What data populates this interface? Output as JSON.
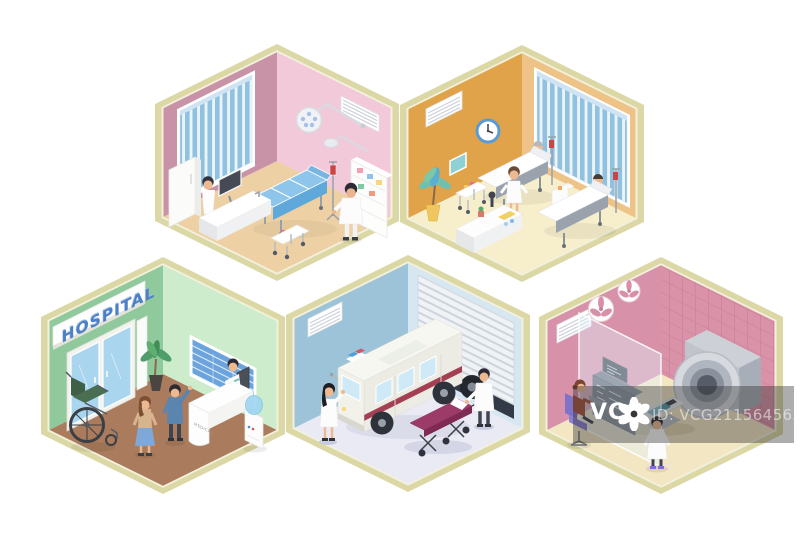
{
  "reception": {
    "sign": "HOSPITAL",
    "desk_label": "MEDICAL"
  },
  "watermark": {
    "brand": "VCG",
    "id_text": "ID: VCG211564563893",
    "overlay_color": "#adadad",
    "logo_icon": "flower-asterisk"
  },
  "palette": {
    "background": "#ffffff",
    "hex_border": "#dcd8a6",
    "hex_border_inner": "#f3f1dd",
    "operating_room": {
      "left_wall": "#c893a6",
      "right_wall": "#f2c9d9",
      "floor": "#edd1a5",
      "exam_bed": "#8ec5ea"
    },
    "ward": {
      "left_wall": "#e1a349",
      "right_wall": "#eec387",
      "floor": "#f7eecb",
      "clock_ring": "#5b9bd5",
      "blinds": "#90c1de"
    },
    "reception_room": {
      "left_wall": "#90c99b",
      "right_wall": "#cdeccb",
      "floor": "#aa7b5c",
      "sign_text": "#4d7fc4",
      "notice_board": "#6aa3dd",
      "door_glass": "#a9d5ef"
    },
    "garage": {
      "left_wall": "#9dc3d8",
      "right_wall": "#d6e7f2",
      "floor": "#eaeaf5",
      "ambulance_stripe": "#a34053",
      "stretcher": "#9c3a68"
    },
    "scan_room": {
      "left_wall": "#d792aa",
      "tile_wall": "#da92a9",
      "floor": "#f3e6c3",
      "operator_chair": "#8b7fd0",
      "scanner": "#b0b6bf"
    }
  }
}
